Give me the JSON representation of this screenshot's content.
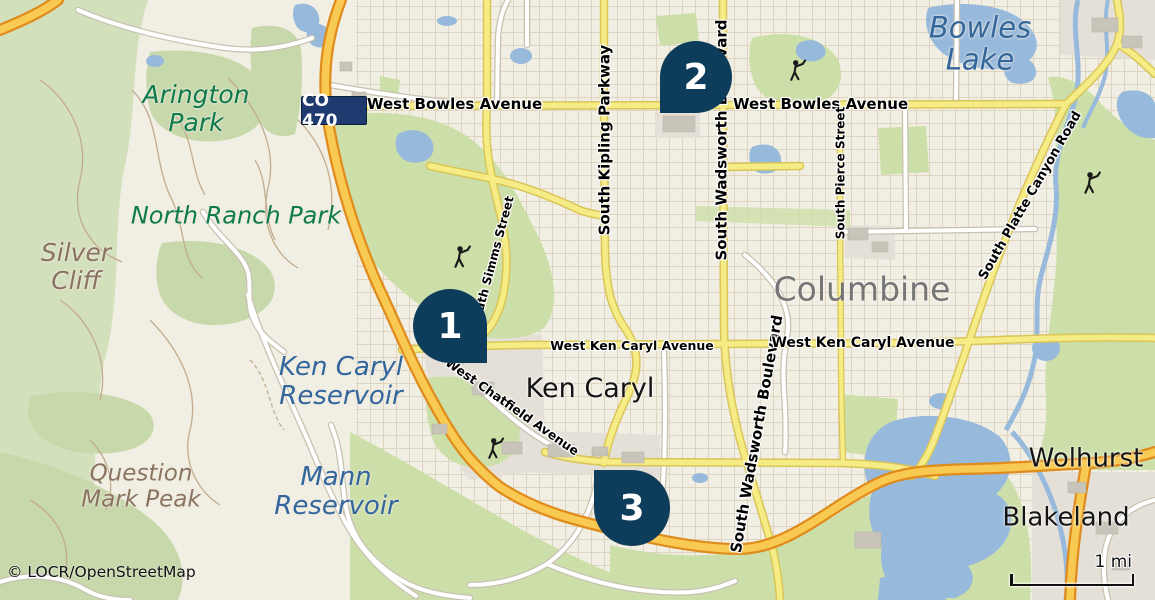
{
  "map": {
    "attribution": "© LOCR/OpenStreetMap",
    "scale_bar": {
      "label": "1 mi"
    },
    "route_badge": {
      "label": "CO 470"
    },
    "markers": [
      {
        "number": "1"
      },
      {
        "number": "2"
      },
      {
        "number": "3"
      }
    ],
    "place_labels": {
      "bowles_lake": "Bowles Lake",
      "arington_park": "Arington Park",
      "north_ranch_park": "North Ranch Park",
      "silver_cliff": "Silver Cliff",
      "ken_caryl_reservoir": "Ken Caryl Reservoir",
      "mann_reservoir": "Mann Reservoir",
      "question_mark_peak": "Question Mark Peak",
      "ken_caryl": "Ken Caryl",
      "columbine": "Columbine",
      "wolhurst": "Wolhurst",
      "blakeland": "Blakeland"
    },
    "road_labels": {
      "west_bowles_avenue_west": "West Bowles Avenue",
      "west_bowles_avenue_east": "West Bowles Avenue",
      "south_kipling_parkway": "South Kipling Parkway",
      "south_wadsworth_boulevard_north": "South Wadsworth Boulevard",
      "south_wadsworth_boulevard_south": "South Wadsworth Boulevard",
      "south_pierce_street": "South Pierce Street",
      "south_platte_canyon_road": "South Platte Canyon Road",
      "west_ken_caryl_avenue_west": "West Ken Caryl Avenue",
      "west_ken_caryl_avenue_east": "West Ken Caryl Avenue",
      "west_chatfield_avenue": "West Chatfield Avenue",
      "south_simms_street": "South Simms Street"
    },
    "colors": {
      "background": "#f1eee3",
      "water": "#97b9dc",
      "water_label": "#33669c",
      "park_green": "#cddfa8",
      "hills_green": "#d3e0bc",
      "park_label": "#0f7a4b",
      "terrain_label": "#8a7360",
      "city_label": "#757575",
      "road_yellow": "#f6ec85",
      "highway_orange": "#f9ca52",
      "highway_casing": "#e08c1c",
      "marker": "#0e3d5c",
      "route_badge_bg": "#1e3a6e"
    }
  }
}
